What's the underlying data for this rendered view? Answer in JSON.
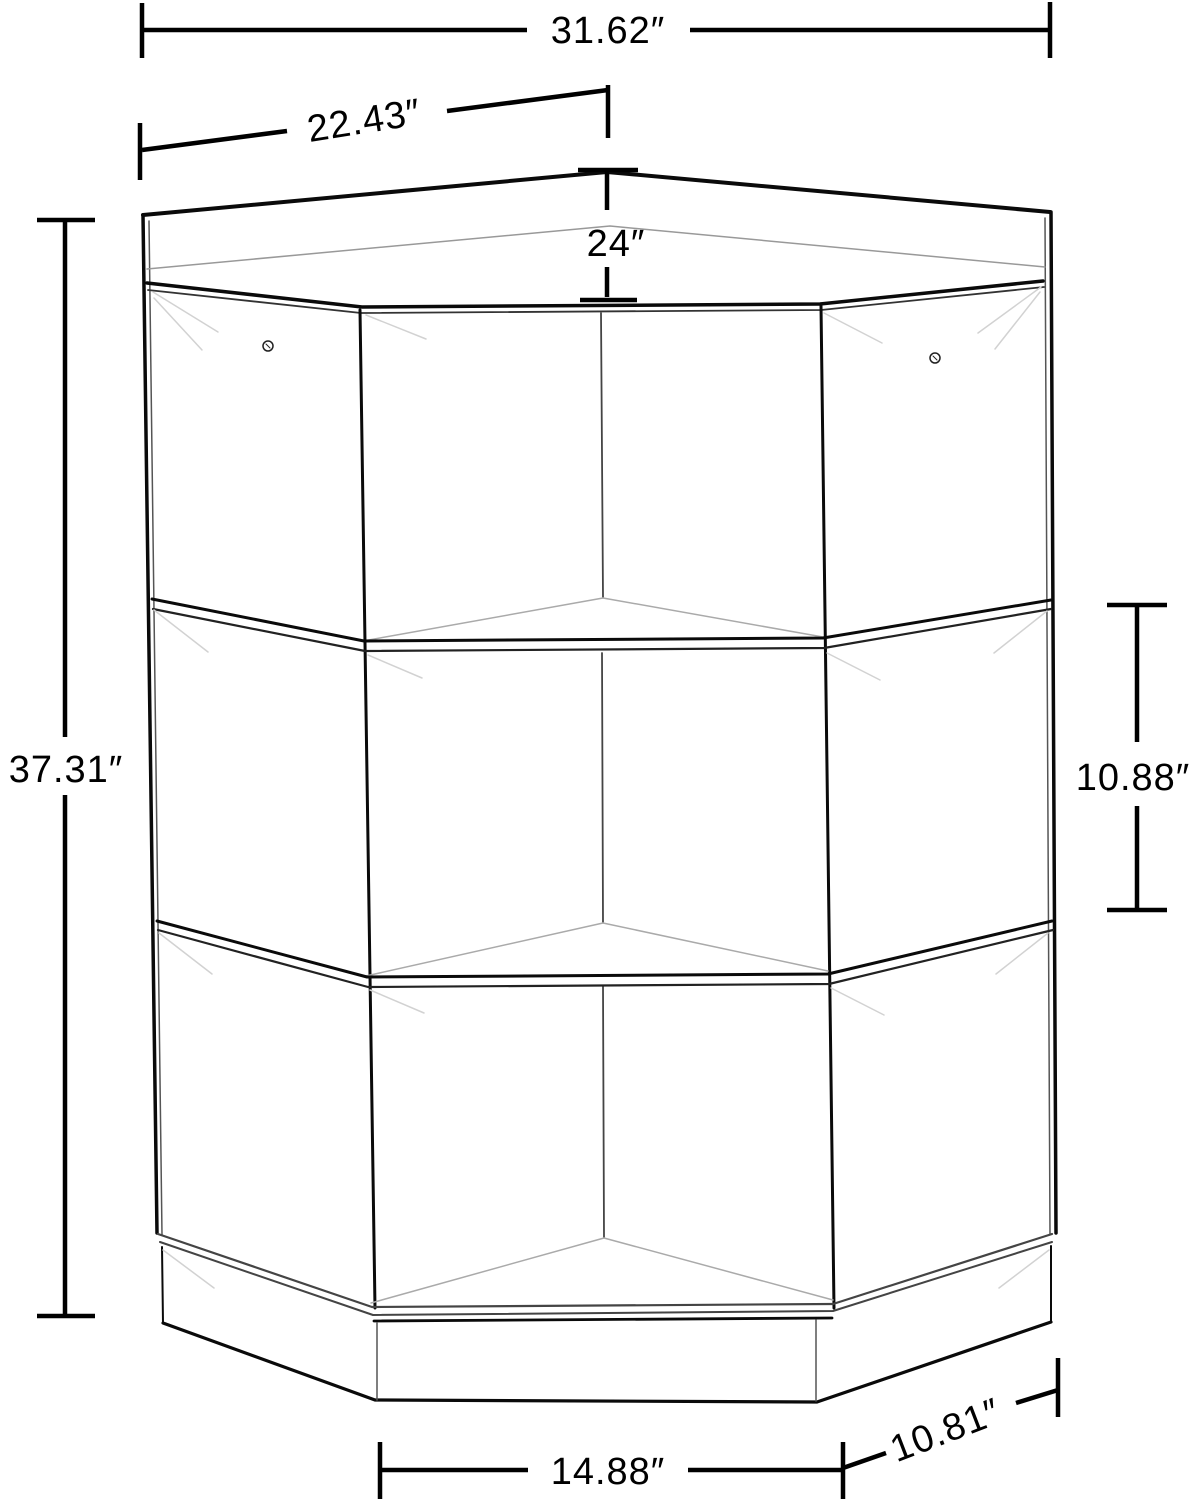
{
  "drawing": {
    "kind": "corner-cabinet-dimension-diagram",
    "units": "inches",
    "line_color": "#000000",
    "background": "#ffffff",
    "dimension_labels": {
      "overall_width": "31.62″",
      "left_section_width": "22.43″",
      "top_depth": "24″",
      "overall_height": "37.31″",
      "cubby_height": "10.88″",
      "front_width": "14.88″",
      "side_depth": "10.81″"
    }
  }
}
